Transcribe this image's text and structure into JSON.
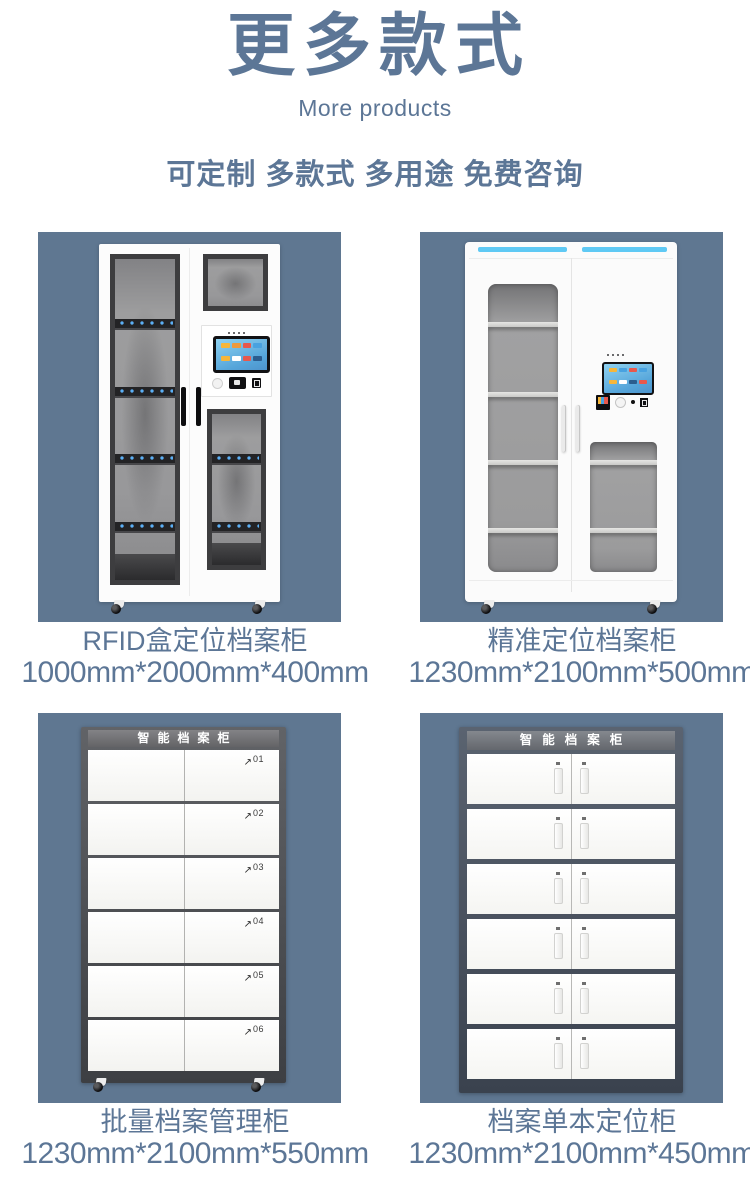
{
  "header": {
    "title": "更多款式",
    "subtitle": "More products",
    "tagline": "可定制 多款式 多用途 免费咨询"
  },
  "products": [
    {
      "name": "RFID盒定位档案柜",
      "dimensions": "1000mm*2000mm*400mm"
    },
    {
      "name": "精准定位档案柜",
      "dimensions": "1230mm*2100mm*500mm"
    },
    {
      "name": "批量档案管理柜",
      "dimensions": "1230mm*2100mm*550mm",
      "panel_title": "智能档案柜",
      "drawer_labels": [
        "01",
        "02",
        "03",
        "04",
        "05",
        "06"
      ]
    },
    {
      "name": "档案单本定位柜",
      "dimensions": "1230mm*2100mm*450mm",
      "panel_title": "智能档案柜"
    }
  ],
  "icons": {
    "open_indicator": "↗"
  },
  "colors": {
    "accent_text": "#5c7696",
    "tile_background": "#5f7791",
    "led_blue": "#5cb0f6",
    "uv_strip": "#5fc9f4",
    "cabinet_frame_dark": "#4b4d51",
    "cabinet_frame_blue": "#49515e"
  }
}
